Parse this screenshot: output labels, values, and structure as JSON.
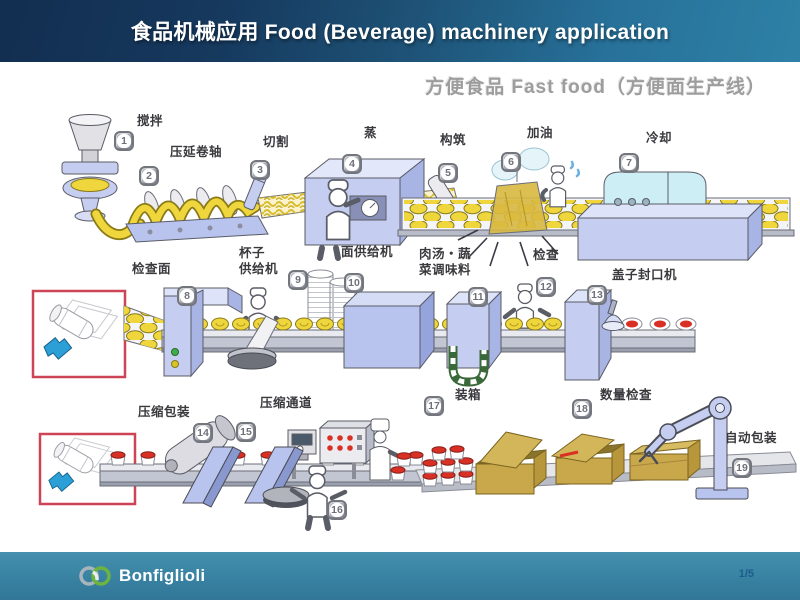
{
  "header": {
    "title": "食品机械应用  Food (Beverage) machinery application"
  },
  "subtitle": "方便食品 Fast food（方便面生产线）",
  "stations": [
    {
      "num": "1",
      "label": "搅拌"
    },
    {
      "num": "2",
      "label": "压延卷轴"
    },
    {
      "num": "3",
      "label": "切割"
    },
    {
      "num": "4",
      "label": "蒸"
    },
    {
      "num": "5",
      "label": "构筑"
    },
    {
      "num": "6",
      "label": "加油"
    },
    {
      "num": "7",
      "label": "冷却"
    },
    {
      "num": "8",
      "label": "检查面"
    },
    {
      "num": "9",
      "label": "杯子\n供给机"
    },
    {
      "num": "10",
      "label": "面供给机"
    },
    {
      "num": "11",
      "label": "肉汤・蔬\n菜调味料"
    },
    {
      "num": "12",
      "label": "检查"
    },
    {
      "num": "13",
      "label": "盖子封口机"
    },
    {
      "num": "14",
      "label": "压缩包装"
    },
    {
      "num": "15",
      "label": "压缩通道"
    },
    {
      "num": "16",
      "label": ""
    },
    {
      "num": "17",
      "label": "装箱"
    },
    {
      "num": "18",
      "label": "数量检查"
    },
    {
      "num": "19",
      "label": "自动包装"
    }
  ],
  "footer": {
    "brand": "Bonfiglioli",
    "page": "1/5"
  },
  "colors": {
    "header_left": "#122e50",
    "header_right": "#2e81a6",
    "footer_teal": "#3a84a4",
    "badge_gray": "#a9abb5",
    "callout_red": "#cc4455",
    "noodle_yellow": "#eed63c",
    "machine_blue": "#c5cdf0",
    "cup_lid_red": "#d93025",
    "box_tan": "#c9a84c",
    "logo_green": "#6cb33f",
    "page_number_blue": "#1c5d8d"
  }
}
